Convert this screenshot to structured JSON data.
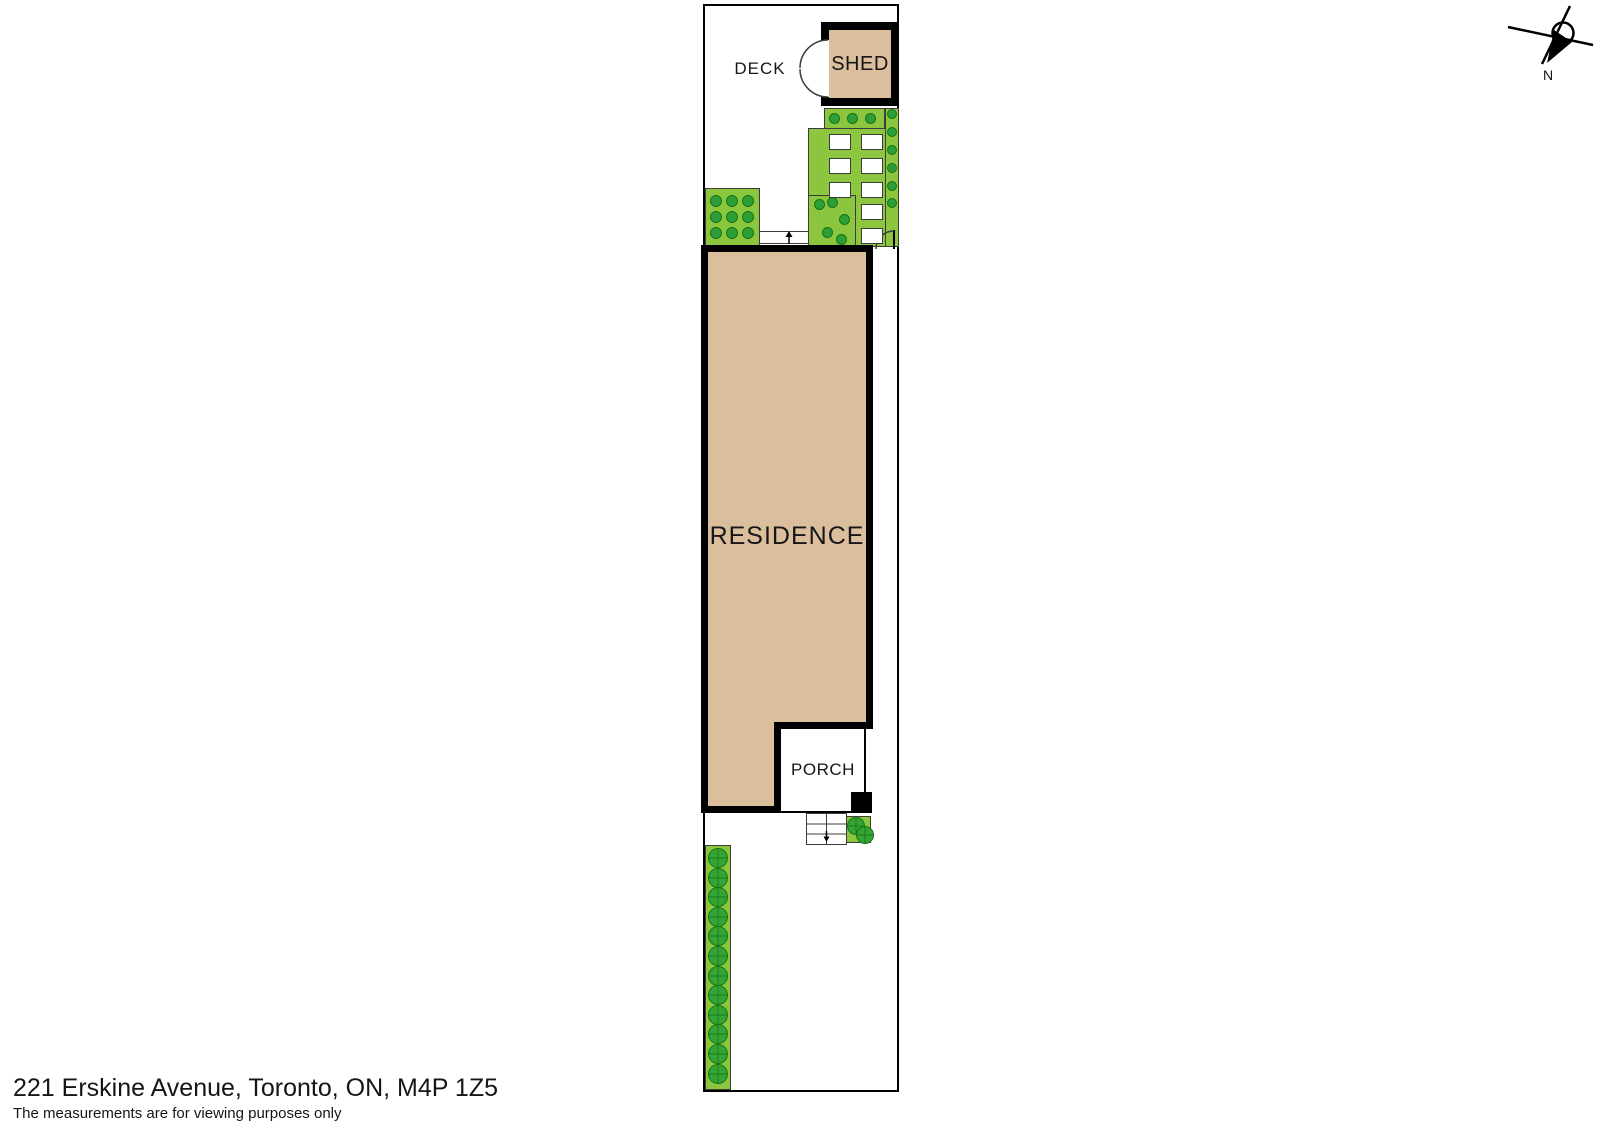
{
  "plan": {
    "deck_label": "DECK",
    "shed_label": "SHED",
    "residence_label": "RESIDENCE",
    "porch_label": "PORCH"
  },
  "compass": {
    "label": "N"
  },
  "footer": {
    "address": "221 Erskine Avenue, Toronto, ON, M4P 1Z5",
    "disclaimer": "The measurements are for viewing purposes only"
  },
  "colors": {
    "residence_fill": "#dbbf9d",
    "lawn_green": "#8cc63e",
    "shrub_green": "#2e9e36",
    "tree_green": "#35a435",
    "outline_black": "#000000"
  },
  "landscaping": {
    "top_strip_shrub_count": 3,
    "right_strip_shrub_count": 6,
    "panel_scatter_shrub_count": 5,
    "left_bed_shrub_rows": 3,
    "left_bed_shrub_cols": 3,
    "paver_left_column_count": 3,
    "paver_right_column_count": 5,
    "porch_bed_tree_count": 2,
    "backyard_tree_count": 12
  }
}
